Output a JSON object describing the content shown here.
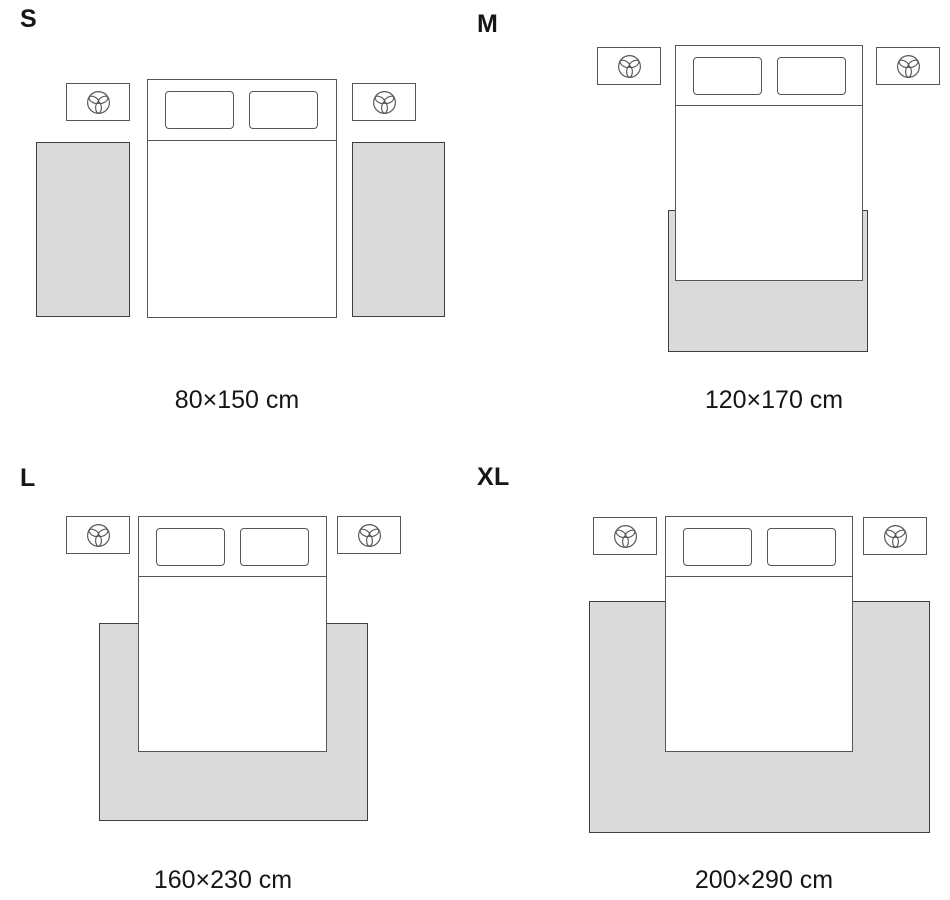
{
  "diagram": {
    "title_visible": false,
    "type": "rug-size-guide",
    "colors": {
      "background": "#ffffff",
      "rug_fill": "#dadada",
      "rug_border": "#3e3e40",
      "line": "#55565a",
      "text": "#161616"
    },
    "icons": {
      "nightstand_icon": "plant-icon"
    },
    "panels": [
      {
        "label": "S",
        "size_text": "80×150 cm",
        "rug_placement": "two side runners beside bed"
      },
      {
        "label": "M",
        "size_text": "120×170 cm",
        "rug_placement": "under foot of bed"
      },
      {
        "label": "L",
        "size_text": "160×230 cm",
        "rug_placement": "under lower two-thirds of bed"
      },
      {
        "label": "XL",
        "size_text": "200×290 cm",
        "rug_placement": "under bed, full surround"
      }
    ]
  }
}
